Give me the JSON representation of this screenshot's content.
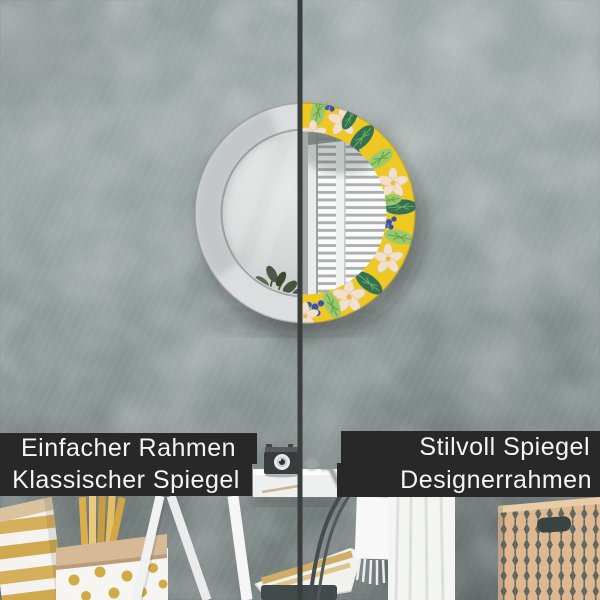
{
  "labels": {
    "left": {
      "line1": "Einfacher Rahmen",
      "line2": "Klassischer Spiegel"
    },
    "right": {
      "line1": "Stilvoll Spiegel",
      "line2": "Designerrahmen"
    }
  },
  "colors": {
    "label_background": "#282828",
    "label_text": "#f5f5f5",
    "wall_base": "#8c9795",
    "divider_line": "#343837",
    "mirror_frame_left": "#dadcdd",
    "mirror_glass_left": "#ced3d2",
    "pattern_yellow": "#eec71d",
    "pattern_green_light": "#9ac768",
    "pattern_green_dark": "#2f6e4e",
    "pattern_cream": "#f2dfc9",
    "pattern_blue": "#3150ae",
    "gold_accent": "#d2a94e",
    "basket_tan": "#dcb68d",
    "basket_motif": "#4e5a58"
  },
  "scene": {
    "left_side": "round mirror half with plain white frame",
    "right_side": "round mirror half with tropical designer frame",
    "objects": [
      "wall",
      "round-mirror",
      "window-reflection",
      "plant-reflection",
      "divider-line",
      "striped-gift-bag",
      "polka-dot-bag",
      "gold-sticks",
      "easel-legs",
      "side-table",
      "vintage-camera",
      "gold-striped-pillow",
      "dark-stool",
      "chair-frame",
      "fringed-towel",
      "knit-blanket",
      "patterned-storage-basket"
    ]
  }
}
